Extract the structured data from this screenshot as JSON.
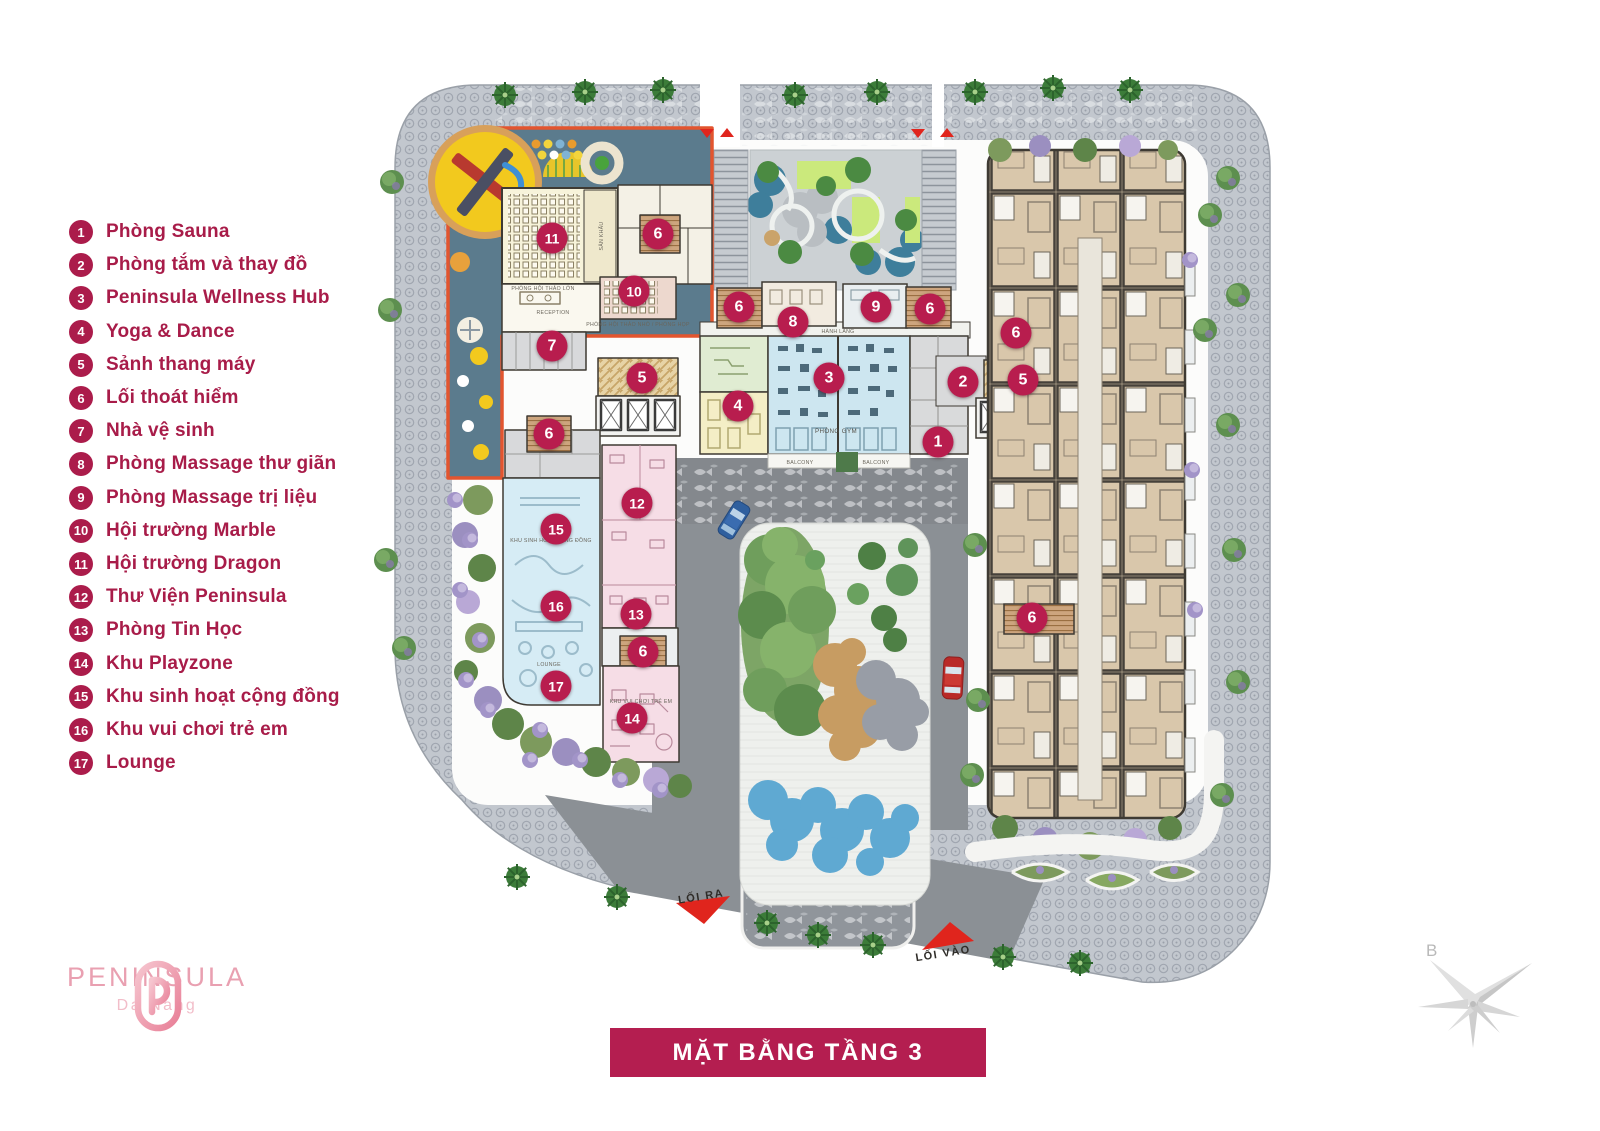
{
  "accent": {
    "crimson": "#b41e50",
    "legend_text": "#a81c49",
    "orange_outline": "#e2552f",
    "logo_pink": "#e9a0b1"
  },
  "legend": {
    "items": [
      {
        "n": "1",
        "label": "Phòng Sauna"
      },
      {
        "n": "2",
        "label": "Phòng tắm và thay đồ"
      },
      {
        "n": "3",
        "label": "Peninsula Wellness Hub"
      },
      {
        "n": "4",
        "label": "Yoga & Dance"
      },
      {
        "n": "5",
        "label": "Sảnh thang máy"
      },
      {
        "n": "6",
        "label": "Lối thoát hiểm"
      },
      {
        "n": "7",
        "label": "Nhà vệ sinh"
      },
      {
        "n": "8",
        "label": "Phòng Massage thư giãn"
      },
      {
        "n": "9",
        "label": "Phòng Massage trị liệu"
      },
      {
        "n": "10",
        "label": "Hội trường Marble"
      },
      {
        "n": "11",
        "label": "Hội trường Dragon"
      },
      {
        "n": "12",
        "label": "Thư Viện Peninsula"
      },
      {
        "n": "13",
        "label": "Phòng Tin Học"
      },
      {
        "n": "14",
        "label": "Khu Playzone"
      },
      {
        "n": "15",
        "label": "Khu sinh hoạt cộng đồng"
      },
      {
        "n": "16",
        "label": "Khu vui chơi trẻ em"
      },
      {
        "n": "17",
        "label": "Lounge"
      }
    ]
  },
  "plan": {
    "badges": [
      {
        "n": "1",
        "x": 938,
        "y": 442
      },
      {
        "n": "2",
        "x": 963,
        "y": 382
      },
      {
        "n": "3",
        "x": 829,
        "y": 378
      },
      {
        "n": "4",
        "x": 738,
        "y": 406
      },
      {
        "n": "5",
        "x": 642,
        "y": 378
      },
      {
        "n": "5",
        "x": 1023,
        "y": 380
      },
      {
        "n": "6",
        "x": 658,
        "y": 234
      },
      {
        "n": "6",
        "x": 739,
        "y": 307
      },
      {
        "n": "6",
        "x": 930,
        "y": 309
      },
      {
        "n": "6",
        "x": 1016,
        "y": 333
      },
      {
        "n": "6",
        "x": 549,
        "y": 434
      },
      {
        "n": "6",
        "x": 643,
        "y": 652
      },
      {
        "n": "6",
        "x": 1032,
        "y": 618
      },
      {
        "n": "7",
        "x": 552,
        "y": 346
      },
      {
        "n": "8",
        "x": 793,
        "y": 322
      },
      {
        "n": "9",
        "x": 876,
        "y": 307
      },
      {
        "n": "10",
        "x": 634,
        "y": 291
      },
      {
        "n": "11",
        "x": 552,
        "y": 238
      },
      {
        "n": "12",
        "x": 637,
        "y": 503
      },
      {
        "n": "13",
        "x": 636,
        "y": 614
      },
      {
        "n": "14",
        "x": 632,
        "y": 718
      },
      {
        "n": "15",
        "x": 556,
        "y": 529
      },
      {
        "n": "16",
        "x": 556,
        "y": 606
      },
      {
        "n": "17",
        "x": 556,
        "y": 686
      }
    ],
    "labels": {
      "phong_gym": "PHÒNG GYM",
      "balcony": "BALCONY",
      "lounge": "LOUNGE",
      "reception": "RECEPTION",
      "san_khau": "SÂN KHẤU",
      "hoi_thao_lon": "PHÒNG HỘI THẢO LỚN",
      "hoi_thao_nho": "PHÒNG HỘI THẢO NHỎ / PHÒNG HỌP",
      "hanh_lang": "HÀNH LANG",
      "khu_sinh_hoat": "KHU SINH HOẠT CỘNG ĐỒNG",
      "khu_vui_choi": "KHU VUI CHƠI TRẺ EM",
      "loi_ra": "LỐI RA",
      "loi_vao": "LỐI VÀO"
    }
  },
  "logo": {
    "brand": "PENINSULA",
    "city": "Da Nang"
  },
  "title_banner": {
    "text": "MẶT BẰNG TẦNG 3"
  },
  "compass": {
    "north_label": "B"
  }
}
